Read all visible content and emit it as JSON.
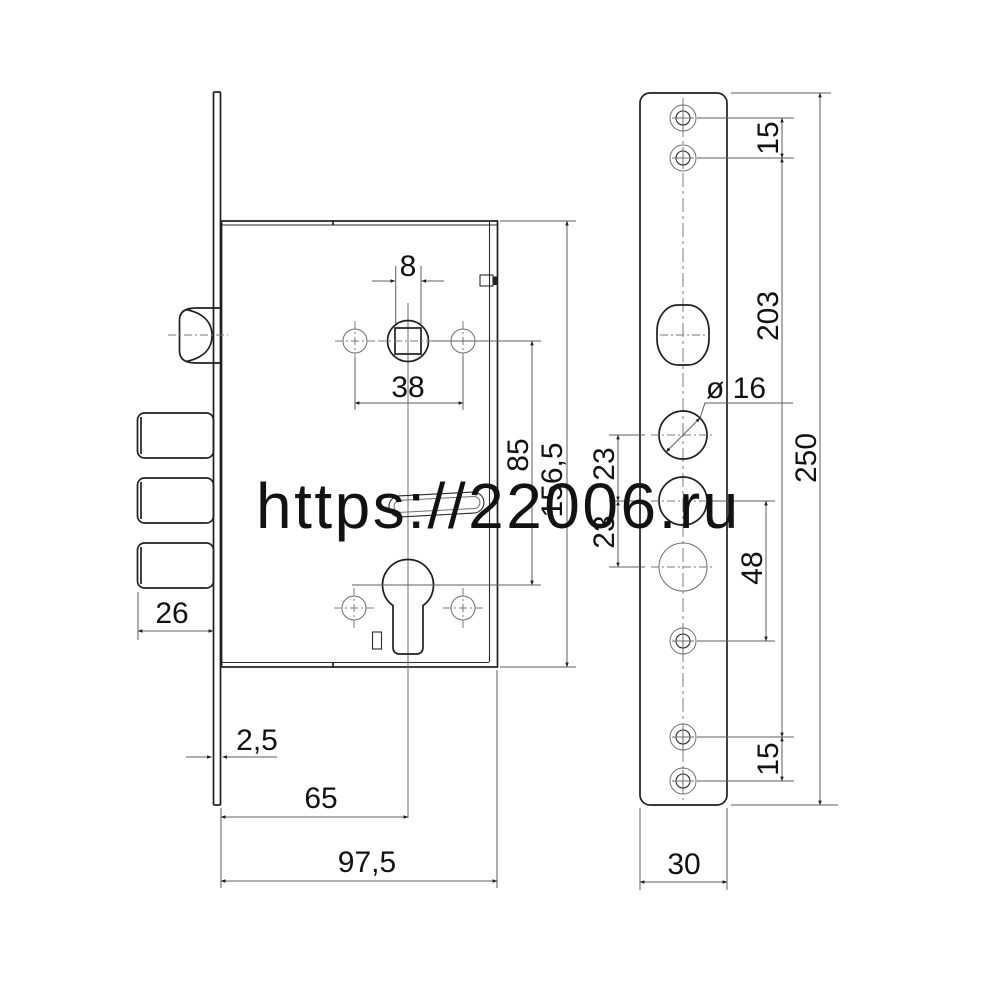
{
  "drawing_title": "mortise-lock-technical-drawing",
  "watermark": {
    "text": "https://22006.ru",
    "color": "#f70808"
  },
  "lock_body_view": {
    "dims": {
      "spindle_square": "8",
      "handle_holes_span": "38",
      "hub_to_cylinder": "85",
      "case_height": "156,5",
      "bolt_throw": "26",
      "faceplate_thickness": "2,5",
      "backset": "65",
      "case_depth": "97,5"
    }
  },
  "faceplate_view": {
    "dims": {
      "top_screw_gap": "15",
      "screw_span": "203",
      "plate_length": "250",
      "hole_diameter_label": "ø 16",
      "hole_gap_upper": "23",
      "hole_gap_lower": "23",
      "hole_to_screw": "48",
      "bottom_screw_gap": "15",
      "plate_width": "30"
    }
  }
}
